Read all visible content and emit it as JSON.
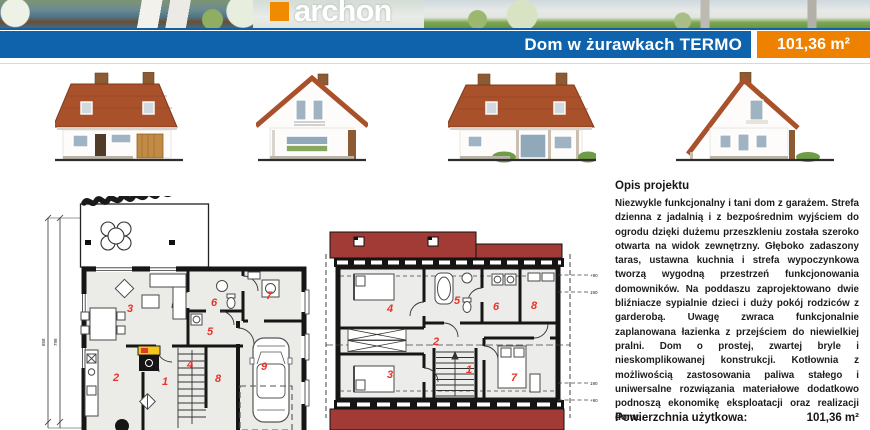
{
  "header": {
    "brand": "archon",
    "title": "Dom w żurawkach TERMO",
    "area_badge": "101,36 m²"
  },
  "description": {
    "heading": "Opis projektu",
    "body": "Niezwykle funkcjonalny i tani dom z garażem. Strefa dzienna z jadalnią i z bezpośrednim wyjściem do ogrodu dzięki dużemu przeszkleniu została szeroko otwarta na widok zewnętrzny. Głęboko zadaszony taras, ustawna kuchnia i strefa wypoczynkowa tworzą wygodną przestrzeń funkcjonowania domowników. Na poddaszu zaprojektowano dwie bliźniacze sypialnie dzieci i duży pokój rodziców z garderobą. Uwagę zwraca funkcjonalnie zaplanowana łazienka z przejściem do niewielkiej pralni. Dom o prostej, zwartej bryle i nieskomplikowanej konstrukcji. Kotłownia z możliwością zastosowania paliwa stałego i uniwersalne rozwiązania materiałowe dodatkowo podnoszą ekonomikę eksploatacji oraz realizacji domu.",
    "area_label": "Powierzchnia użytkowa:",
    "area_value": "101,36 m²"
  },
  "plans": {
    "ground": {
      "rooms": [
        "1",
        "2",
        "3",
        "4",
        "5",
        "6",
        "7",
        "8",
        "9"
      ],
      "dims": [
        "858",
        "798"
      ]
    },
    "attic": {
      "rooms": [
        "1",
        "2",
        "3",
        "4",
        "5",
        "6",
        "7",
        "8"
      ],
      "height_marks": [
        "+90",
        "190",
        "190",
        "+90"
      ]
    }
  },
  "colors": {
    "bar_blue": "#0f62ac",
    "badge_orange": "#ee8100",
    "plan_roof_red": "#a23a36",
    "label_red": "#e8332a"
  }
}
